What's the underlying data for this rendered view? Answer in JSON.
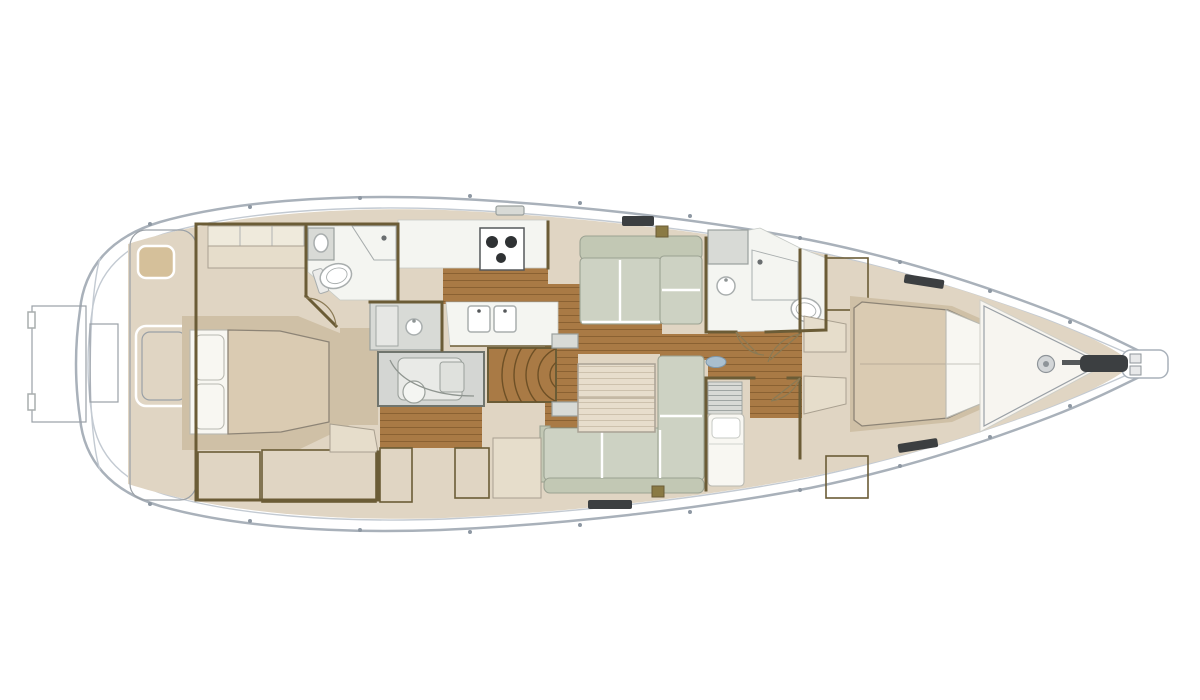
{
  "image": {
    "kind": "yacht-interior-deck-plan",
    "orientation": "bow-right-stern-left",
    "visible_text": []
  },
  "colors": {
    "hull_line": "#a9b1ba",
    "deck_line": "#c3cad2",
    "deck_beige": "#e0d5c3",
    "teak": "#d5c09a",
    "teak_line": "#b89c71",
    "teak_edge": "#9aa0a6",
    "wood": "#a97a45",
    "wood_line": "#8a6132",
    "table_wood": "#e7ddcc",
    "table_line": "#cdc1ad",
    "wall": "#6b5c36",
    "floor_white": "#f4f5f1",
    "room_edge": "#c6cac6",
    "sofa": "#cdd2c3",
    "sofa_dark": "#c2c8b4",
    "sofa_line": "#9ba292",
    "bed_tan": "#dacbb2",
    "bed_line": "#8d8476",
    "tan_mid": "#cfc0a6",
    "pillow": "#f8f7f2",
    "pillow_line": "#b9b9b1",
    "cushion": "#efeadc",
    "cushion_line": "#aaa596",
    "bench": "#e6ddcb",
    "bench_line": "#a9a090",
    "fixture_line": "#a9aeae",
    "gray_unit": "#d8dad6",
    "gray_line": "#9aa09e",
    "stripe_locker": "#d8ccb5",
    "stripe_line": "#b4a68b",
    "shower_bg": "#fbfcfa",
    "shower_line": "#c3c7c3",
    "wardrobe_bg": "#d2c6b0",
    "wardrobe_line": "#a5946f",
    "hatch_dark": "#3c3f41",
    "deck_box": "#8a7a44",
    "engine_bg": "#d4d6d3",
    "engine_edge": "#70756e",
    "engine_part": "#e9eae7",
    "engine_line": "#9aa09b",
    "door": "#8a7a55",
    "stanchion": "#8e98a3",
    "mast_blue": "#a9bfcf",
    "mast_line": "#7e98ab",
    "steel": "#d3d6d8",
    "steel_line": "#8e9499"
  },
  "regions": [
    "swim-platform",
    "transom-steps",
    "aft-cockpit-teak",
    "owner-cabin-aft",
    "aft-head",
    "utility-unit",
    "engine-room",
    "galley",
    "companionway-stairs",
    "saloon",
    "nav-station",
    "forward-head",
    "bunk-cabin",
    "forward-cabin",
    "foredeck-teak",
    "anchor-windlass",
    "bowsprit"
  ]
}
